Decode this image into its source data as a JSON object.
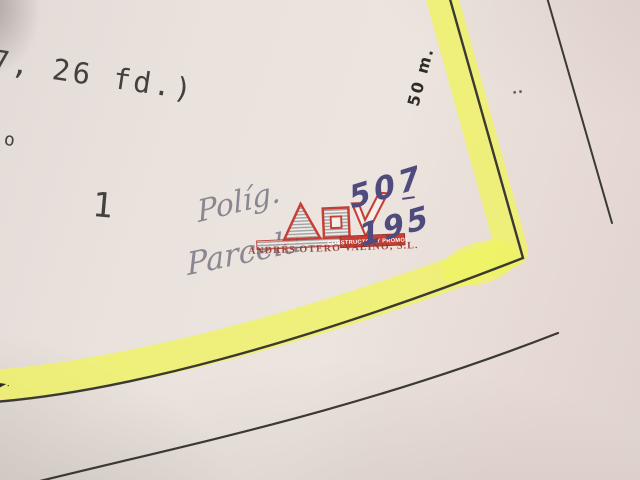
{
  "photo": {
    "printed": {
      "dimension_note": "7, 26 fd.)",
      "point_o": "o",
      "parcel_label_1": "1",
      "ditto_marks": "..",
      "edge_mark": "►."
    },
    "annotations": {
      "scale": "50 m.",
      "word_line1": "Políg.",
      "word_line2": "Parcela",
      "number_top": "507",
      "number_bottom": "195"
    },
    "watermark": {
      "letters": "AOV",
      "tagline": "CONSTRUCTOR Y PROMOTOR",
      "company": "ANDRÉS OTERO VALIÑO, S.L."
    },
    "colors": {
      "highlighter": "#f0f45f",
      "line_ink": "#3b3933",
      "pen_ink": "#4f4b7c",
      "faded_pen": "#8a8794",
      "logo_red": "#c4322a",
      "paper": "#e8e0da"
    }
  }
}
